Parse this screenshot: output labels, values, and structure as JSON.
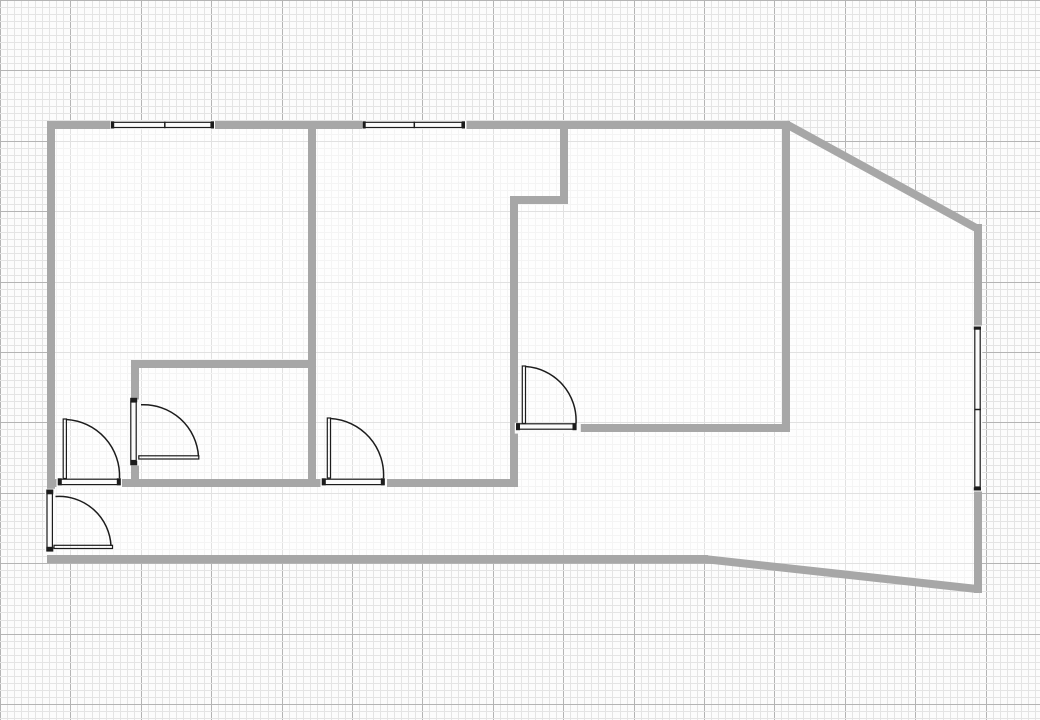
{
  "canvas": {
    "width": 1040,
    "height": 720,
    "background": "#fcfcfc"
  },
  "grid": {
    "minor_spacing": 7.04,
    "major_every": 10,
    "minor_color": "#e4e4e4",
    "major_color": "#b4b4b4"
  },
  "style": {
    "wall_color": "#a7a7a7",
    "wall_thickness": 8,
    "line_color": "#1c1c1c",
    "gap_fill": "#fbfbfb",
    "floor_fill": "rgba(255,255,255,0.6)"
  },
  "floor_outline": [
    [
      51,
      125
    ],
    [
      786,
      125
    ],
    [
      978,
      228
    ],
    [
      978,
      589
    ],
    [
      704,
      559
    ],
    [
      51,
      559
    ]
  ],
  "walls": [
    {
      "name": "outer-wall-top",
      "x1": 47,
      "y1": 125,
      "x2": 790,
      "y2": 125
    },
    {
      "name": "outer-wall-top-right-diagonal",
      "x1": 786,
      "y1": 124,
      "x2": 978,
      "y2": 229
    },
    {
      "name": "outer-wall-right",
      "x1": 978,
      "y1": 224,
      "x2": 978,
      "y2": 593
    },
    {
      "name": "outer-wall-bottom-right-diagonal",
      "x1": 704,
      "y1": 559,
      "x2": 977,
      "y2": 589
    },
    {
      "name": "outer-wall-bottom",
      "x1": 47,
      "y1": 559,
      "x2": 708,
      "y2": 559
    },
    {
      "name": "outer-wall-left",
      "x1": 51,
      "y1": 121,
      "x2": 51,
      "y2": 491
    },
    {
      "name": "partition-vertical-left",
      "x1": 312,
      "y1": 121,
      "x2": 312,
      "y2": 487
    },
    {
      "name": "partition-bottom-a",
      "x1": 47,
      "y1": 483,
      "x2": 60,
      "y2": 483
    },
    {
      "name": "partition-bottom-b",
      "x1": 120,
      "y1": 483,
      "x2": 325,
      "y2": 483
    },
    {
      "name": "partition-bottom-c",
      "x1": 384,
      "y1": 483,
      "x2": 518,
      "y2": 483
    },
    {
      "name": "partition-inner-room-top",
      "x1": 131,
      "y1": 364,
      "x2": 316,
      "y2": 364
    },
    {
      "name": "partition-inner-room-left-upper",
      "x1": 135,
      "y1": 360,
      "x2": 135,
      "y2": 400
    },
    {
      "name": "partition-inner-room-left-lower",
      "x1": 135,
      "y1": 464,
      "x2": 135,
      "y2": 487
    },
    {
      "name": "partition-vertical-middle",
      "x1": 514,
      "y1": 196,
      "x2": 514,
      "y2": 487
    },
    {
      "name": "partition-notch-horizontal",
      "x1": 510,
      "y1": 200,
      "x2": 568,
      "y2": 200
    },
    {
      "name": "partition-notch-vertical",
      "x1": 564,
      "y1": 121,
      "x2": 564,
      "y2": 204
    },
    {
      "name": "partition-vertical-right",
      "x1": 786,
      "y1": 121,
      "x2": 786,
      "y2": 432
    },
    {
      "name": "partition-right-room-bottom",
      "x1": 576,
      "y1": 428,
      "x2": 790,
      "y2": 428
    }
  ],
  "symbols": [
    {
      "name": "window-top-left",
      "kind": "window",
      "primitives": [
        {
          "t": "rect",
          "x": 110.5,
          "y": 120.5,
          "w": 104.5,
          "h": 9,
          "f": "gap"
        },
        {
          "t": "rect",
          "x": 113,
          "y": 122.3,
          "w": 98,
          "h": 5.2,
          "o": 1
        },
        {
          "t": "rect",
          "x": 111,
          "y": 121.3,
          "w": 3.2,
          "h": 7.2,
          "f": "dark"
        },
        {
          "t": "rect",
          "x": 210.8,
          "y": 121.3,
          "w": 3.2,
          "h": 7.2,
          "f": "dark"
        },
        {
          "t": "line",
          "x1": 164.8,
          "y1": 121.6,
          "x2": 164.8,
          "y2": 128.2
        }
      ]
    },
    {
      "name": "window-top-middle",
      "kind": "window",
      "primitives": [
        {
          "t": "rect",
          "x": 362,
          "y": 120.5,
          "w": 104.5,
          "h": 9,
          "f": "gap"
        },
        {
          "t": "rect",
          "x": 364.5,
          "y": 122.3,
          "w": 97.5,
          "h": 5.2,
          "o": 1
        },
        {
          "t": "rect",
          "x": 362.5,
          "y": 121.3,
          "w": 3.2,
          "h": 7.2,
          "f": "dark"
        },
        {
          "t": "rect",
          "x": 461.8,
          "y": 121.3,
          "w": 3.2,
          "h": 7.2,
          "f": "dark"
        },
        {
          "t": "line",
          "x1": 414.3,
          "y1": 121.6,
          "x2": 414.3,
          "y2": 128.2
        }
      ]
    },
    {
      "name": "window-right",
      "kind": "window",
      "primitives": [
        {
          "t": "rect",
          "x": 973.3,
          "y": 325.5,
          "w": 9,
          "h": 166,
          "f": "gap"
        },
        {
          "t": "rect",
          "x": 974.8,
          "y": 328,
          "w": 5.4,
          "h": 159,
          "o": 1
        },
        {
          "t": "rect",
          "x": 973.8,
          "y": 326.5,
          "w": 7.2,
          "h": 3.2,
          "f": "dark"
        },
        {
          "t": "rect",
          "x": 973.8,
          "y": 487.3,
          "w": 7.2,
          "h": 3.2,
          "f": "dark"
        },
        {
          "t": "line",
          "x1": 974.4,
          "y1": 409.5,
          "x2": 980.9,
          "y2": 409.5
        }
      ]
    },
    {
      "name": "door-left-room",
      "kind": "door",
      "primitives": [
        {
          "t": "rect",
          "x": 56.5,
          "y": 478,
          "w": 65.5,
          "h": 10.5,
          "f": "gap"
        },
        {
          "t": "rect",
          "x": 58.5,
          "y": 479.2,
          "w": 61.5,
          "h": 5.4,
          "o": 1
        },
        {
          "t": "rect",
          "x": 57.8,
          "y": 478.3,
          "w": 4,
          "h": 7,
          "f": "dark"
        },
        {
          "t": "rect",
          "x": 116.8,
          "y": 478.3,
          "w": 4,
          "h": 7,
          "f": "dark"
        },
        {
          "t": "rect",
          "x": 63.2,
          "y": 419,
          "w": 3.2,
          "h": 59.5,
          "o": 1
        },
        {
          "t": "arc",
          "x1": 66.4,
          "y1": 419.5,
          "x2": 119.5,
          "y2": 478.3,
          "r": 56.5
        }
      ]
    },
    {
      "name": "door-inner-room",
      "kind": "door",
      "primitives": [
        {
          "t": "rect",
          "x": 128.8,
          "y": 399.5,
          "w": 10.8,
          "h": 66,
          "f": "gap"
        },
        {
          "t": "rect",
          "x": 130.8,
          "y": 402,
          "w": 5.4,
          "h": 58.5,
          "o": 1
        },
        {
          "t": "rect",
          "x": 130.2,
          "y": 397.8,
          "w": 7,
          "h": 4.5,
          "f": "dark"
        },
        {
          "t": "rect",
          "x": 130.2,
          "y": 460.8,
          "w": 7,
          "h": 4.5,
          "f": "dark"
        },
        {
          "t": "rect",
          "x": 138.8,
          "y": 455.8,
          "w": 60,
          "h": 3.2,
          "o": 1
        },
        {
          "t": "arc",
          "x1": 141,
          "y1": 404.8,
          "x2": 198.5,
          "y2": 456.5,
          "r": 55
        }
      ]
    },
    {
      "name": "door-middle-room",
      "kind": "door",
      "primitives": [
        {
          "t": "rect",
          "x": 320.5,
          "y": 478,
          "w": 66.5,
          "h": 10.5,
          "f": "gap"
        },
        {
          "t": "rect",
          "x": 322.5,
          "y": 479.2,
          "w": 61.5,
          "h": 5.4,
          "o": 1
        },
        {
          "t": "rect",
          "x": 321.8,
          "y": 478.3,
          "w": 4,
          "h": 7,
          "f": "dark"
        },
        {
          "t": "rect",
          "x": 380.8,
          "y": 478.3,
          "w": 4,
          "h": 7,
          "f": "dark"
        },
        {
          "t": "rect",
          "x": 327.3,
          "y": 418,
          "w": 3.2,
          "h": 60,
          "o": 1
        },
        {
          "t": "arc",
          "x1": 330.5,
          "y1": 418.5,
          "x2": 383.5,
          "y2": 478.3,
          "r": 56.5
        }
      ]
    },
    {
      "name": "door-right-room",
      "kind": "door",
      "primitives": [
        {
          "t": "rect",
          "x": 514.8,
          "y": 422.8,
          "w": 66,
          "h": 10.8,
          "f": "gap"
        },
        {
          "t": "rect",
          "x": 517,
          "y": 423.8,
          "w": 59,
          "h": 5.4,
          "o": 1
        },
        {
          "t": "rect",
          "x": 516,
          "y": 423.2,
          "w": 4,
          "h": 7,
          "f": "dark"
        },
        {
          "t": "rect",
          "x": 572.5,
          "y": 423.2,
          "w": 4,
          "h": 7,
          "f": "dark"
        },
        {
          "t": "rect",
          "x": 522.3,
          "y": 366,
          "w": 3.2,
          "h": 57.5,
          "o": 1
        },
        {
          "t": "arc",
          "x1": 525.5,
          "y1": 366.5,
          "x2": 576,
          "y2": 423.5,
          "r": 54
        }
      ]
    },
    {
      "name": "door-entry-bottom-left",
      "kind": "door",
      "primitives": [
        {
          "t": "rect",
          "x": 44.8,
          "y": 488.8,
          "w": 10.8,
          "h": 66,
          "f": "gap"
        },
        {
          "t": "rect",
          "x": 47,
          "y": 491,
          "w": 5.4,
          "h": 59.5,
          "o": 1
        },
        {
          "t": "rect",
          "x": 46.3,
          "y": 489.5,
          "w": 7,
          "h": 4.8,
          "f": "dark"
        },
        {
          "t": "rect",
          "x": 46.3,
          "y": 546.8,
          "w": 7,
          "h": 4.8,
          "f": "dark"
        },
        {
          "t": "rect",
          "x": 54,
          "y": 545.3,
          "w": 58.5,
          "h": 3.2,
          "o": 1
        },
        {
          "t": "arc",
          "x1": 55.5,
          "y1": 496.5,
          "x2": 111,
          "y2": 546,
          "r": 52
        }
      ]
    }
  ]
}
